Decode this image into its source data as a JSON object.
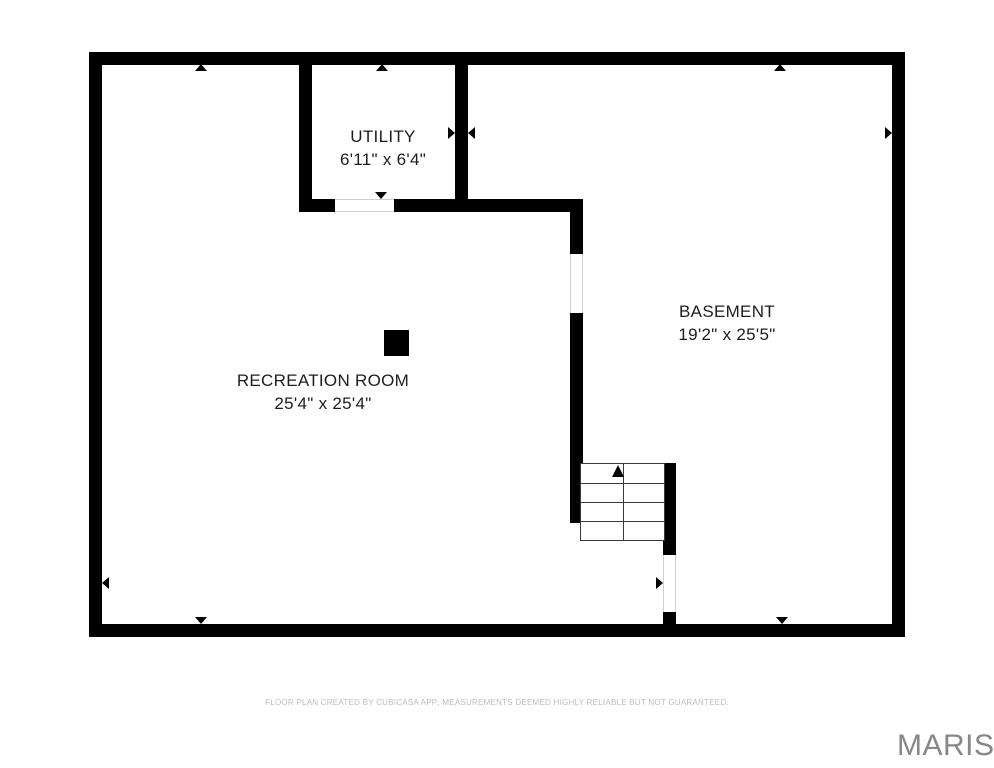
{
  "floor_plan": {
    "rooms": [
      {
        "name": "UTILITY",
        "dimensions": "6'11\" x 6'4\""
      },
      {
        "name": "BASEMENT",
        "dimensions": "19'2\" x 25'5\""
      },
      {
        "name": "RECREATION ROOM",
        "dimensions": "25'4\" x 25'4\""
      }
    ],
    "stairs": {
      "direction": "up"
    },
    "footer": {
      "disclaimer": "FLOOR PLAN CREATED BY CUBICASA APP; MEASUREMENTS DEEMED HIGHLY RELIABLE BUT NOT GUARANTEED."
    },
    "watermark": "MARIS",
    "colors": {
      "wall": "#000000",
      "room_text": "#1d1d1d",
      "disclaimer_text": "#bcbcbc",
      "watermark_text": "#878787",
      "background": "#ffffff"
    }
  }
}
